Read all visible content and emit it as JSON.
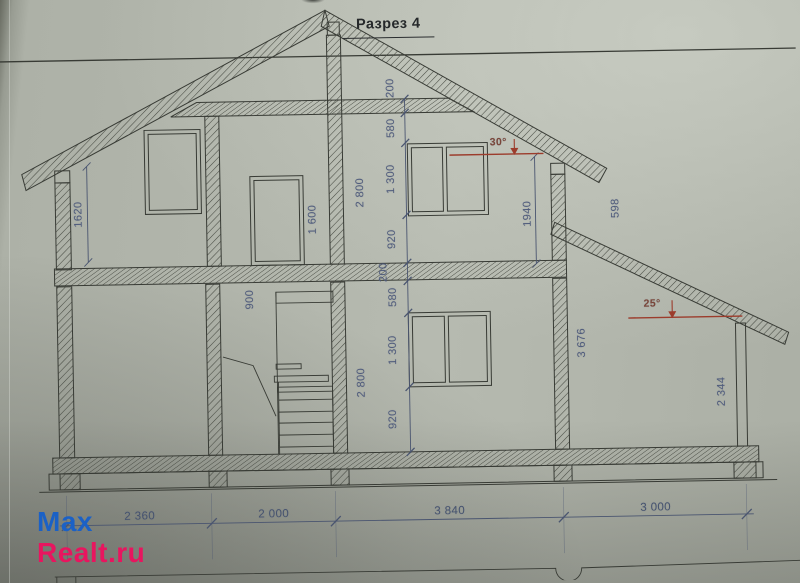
{
  "title": "Разрез 4",
  "watermark": {
    "line1": "Max",
    "line2": "Realt.ru"
  },
  "angles": {
    "main": "30°",
    "porch": "25°"
  },
  "dims": {
    "left_knee_wall": "1620",
    "ceiling_beam": "200",
    "attic_above_window": "580",
    "attic_window": "1 300",
    "attic_sill": "920",
    "attic_height": "2 800",
    "floor_slab": "200",
    "ground_above_window": "580",
    "ground_window": "1 300",
    "ground_sill": "920",
    "ground_height": "2 800",
    "door": "1 600",
    "stair_rail": "900",
    "right_upper": "1940",
    "overhang": "598",
    "right_wall": "3 676",
    "porch_post": "2 344"
  },
  "plan": {
    "d1": "2 360",
    "d2": "2 000",
    "d3": "3 840",
    "d4": "3 000"
  },
  "colors": {
    "ink": "#383b35",
    "dim_text": "#505c7c",
    "annotation_red": "#9c3c2c",
    "watermark_blue": "#1b61c6",
    "watermark_pink": "#e8155f"
  }
}
